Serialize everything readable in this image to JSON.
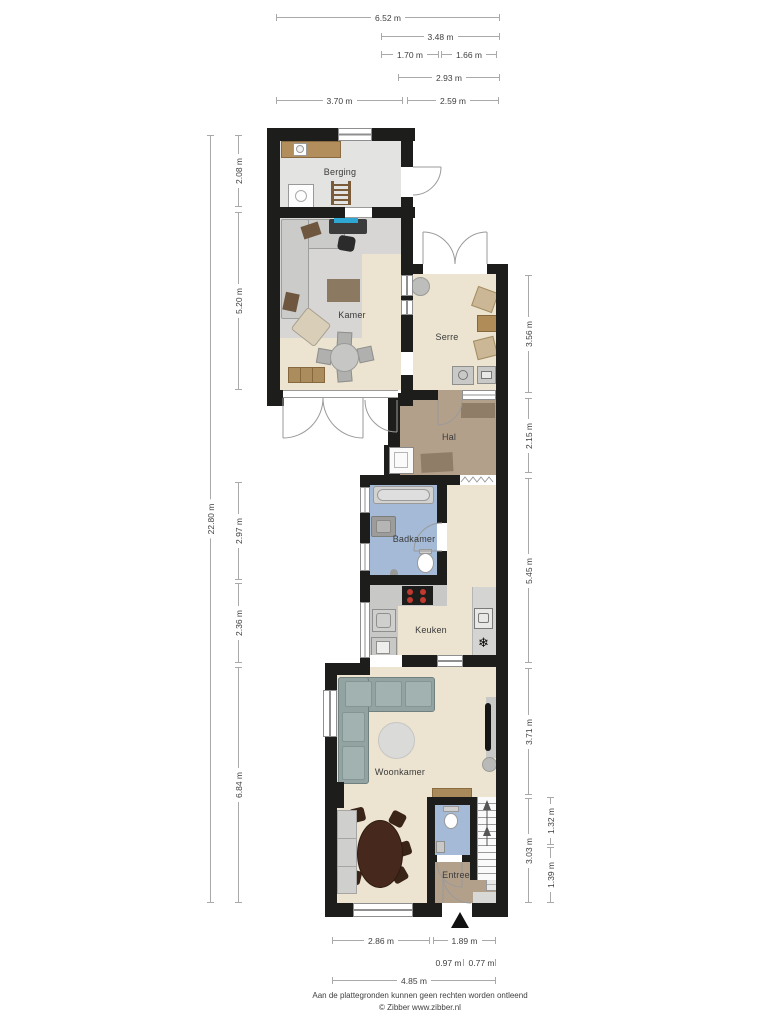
{
  "plan": {
    "rooms": {
      "berging": "Berging",
      "kamer": "Kamer",
      "serre": "Serre",
      "hal": "Hal",
      "badkamer": "Badkamer",
      "keuken": "Keuken",
      "woonkamer": "Woonkamer",
      "entree": "Entree"
    },
    "dimensions": {
      "top": [
        "6.52 m",
        "3.48 m",
        "1.70 m",
        "1.66 m",
        "2.93 m",
        "3.70 m",
        "2.59 m"
      ],
      "left": [
        "2.08 m",
        "5.20 m",
        "22.80 m",
        "2.97 m",
        "2.36 m",
        "6.84 m"
      ],
      "right": [
        "3.56 m",
        "2.15 m",
        "5.45 m",
        "3.71 m",
        "1.32 m",
        "3.03 m",
        "1.39 m"
      ],
      "bottom": [
        "2.86 m",
        "1.89 m",
        "0.97 m",
        "0.77 m",
        "4.85 m"
      ]
    },
    "icons": {
      "freezer": "❄"
    },
    "colors": {
      "wall": "#1d1d1b",
      "floor_living": "#ece4d1",
      "floor_storage": "#e3e3e1",
      "floor_carpet": "#d8d6d4",
      "floor_hall": "#b3a08b",
      "floor_bath": "#a4bad6",
      "sofa": "#93a3a1",
      "wood": "#ab8c5c",
      "stove_burner": "#c03a30"
    },
    "footer": {
      "line1": "Aan de plattegronden kunnen geen rechten worden ontleend",
      "line2": "© Zibber www.zibber.nl"
    }
  }
}
